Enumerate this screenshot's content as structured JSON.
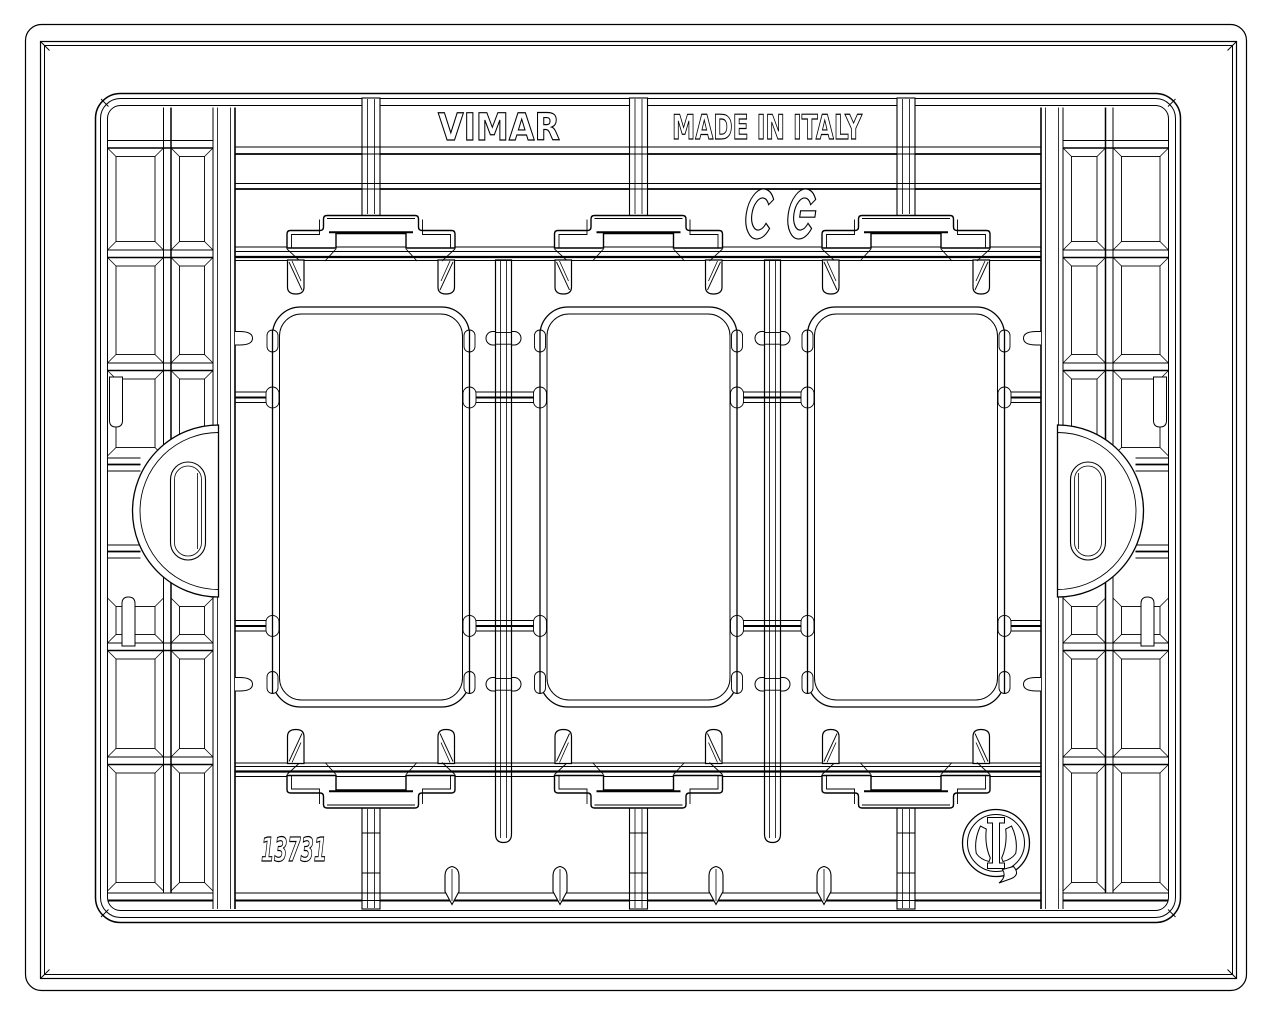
{
  "drawing": {
    "background_color": "#ffffff",
    "line_color": "#000000",
    "labels": {
      "brand": "VIMAR",
      "origin": "MADE IN ITALY",
      "part_number": "13731"
    },
    "marks": {
      "ce": "CE",
      "imq": "IMQ"
    },
    "counts": {
      "module_openings": 3,
      "side_tabs": 2,
      "bottom_pins": 4
    }
  }
}
